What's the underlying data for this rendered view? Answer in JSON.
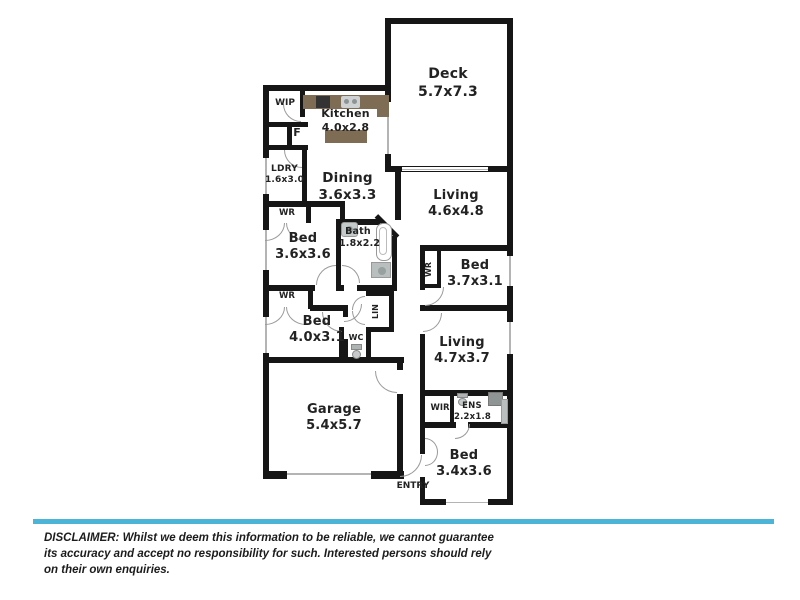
{
  "rooms": {
    "deck": {
      "name": "Deck",
      "dims": "5.7x7.3"
    },
    "kitchen": {
      "name": "Kitchen",
      "dims": "4.0x2.8"
    },
    "dining": {
      "name": "Dining",
      "dims": "3.6x3.3"
    },
    "living_main": {
      "name": "Living",
      "dims": "4.6x4.8"
    },
    "laundry": {
      "name": "LDRY",
      "dims": "1.6x3.0"
    },
    "bed_mid": {
      "name": "Bed",
      "dims": "3.6x3.6"
    },
    "bath": {
      "name": "Bath",
      "dims": "1.8x2.2"
    },
    "bed_right": {
      "name": "Bed",
      "dims": "3.7x3.1"
    },
    "bed_left": {
      "name": "Bed",
      "dims": "4.0x3.1"
    },
    "living_second": {
      "name": "Living",
      "dims": "4.7x3.7"
    },
    "garage": {
      "name": "Garage",
      "dims": "5.4x5.7"
    },
    "ensuite": {
      "name": "ENS",
      "dims": "2.2x1.8"
    },
    "bed_master": {
      "name": "Bed",
      "dims": "3.4x3.6"
    }
  },
  "labels": {
    "wip": "WIP",
    "fridge": "F",
    "wr_a": "WR",
    "wr_b": "WR",
    "wr_c": "WR",
    "linen": "LIN",
    "wc": "WC",
    "wir": "WIR",
    "entry": "ENTRY"
  },
  "footer": {
    "line1": "DISCLAIMER: Whilst we deem this information to be reliable, we cannot guarantee",
    "line2": "its accuracy and accept no responsibility for such. Interested persons should rely",
    "line3": "on their own enquiries."
  },
  "colors": {
    "wall": "#161616",
    "bench": "#7e6c54",
    "divider_line": "#4cb4d6",
    "fixture": "#b9bebe"
  }
}
